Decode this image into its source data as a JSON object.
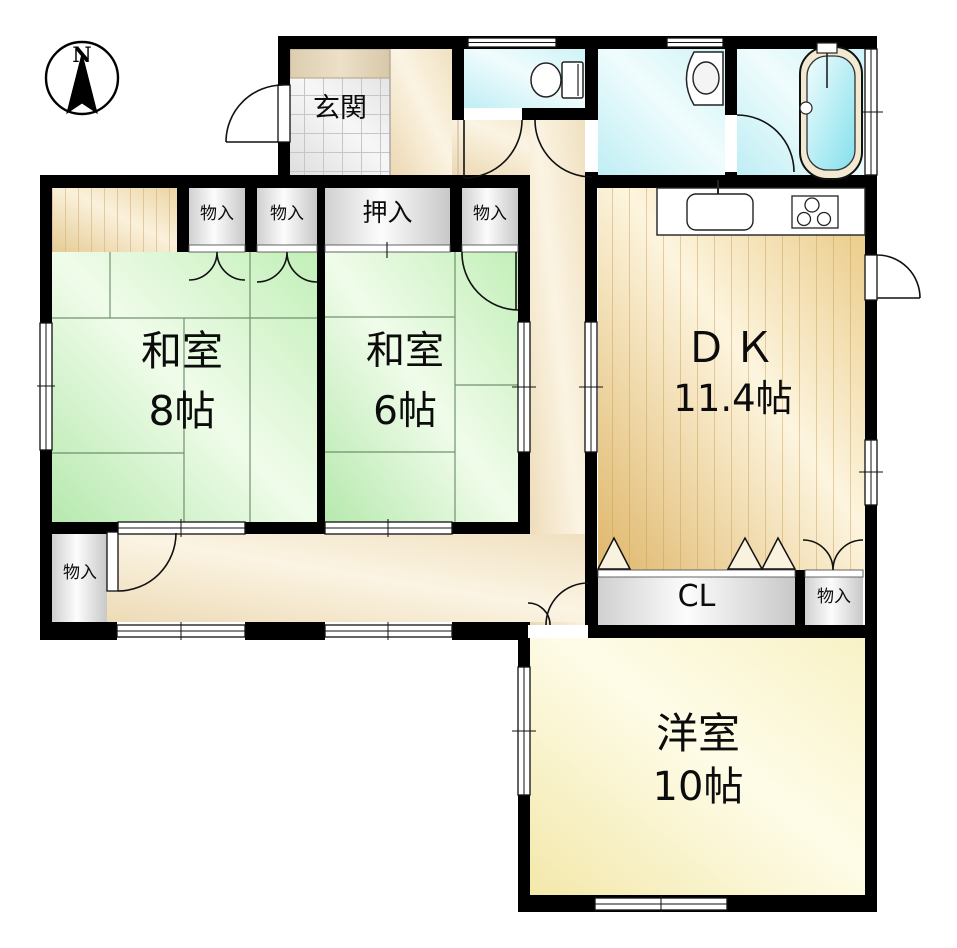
{
  "compass": {
    "label": "N"
  },
  "rooms": {
    "genkan": {
      "label": "玄関"
    },
    "washitsu8": {
      "name": "和室",
      "size": "8帖"
    },
    "washitsu6": {
      "name": "和室",
      "size": "6帖"
    },
    "dk": {
      "name": "ＤＫ",
      "size": "11.4帖"
    },
    "youshitsu": {
      "name": "洋室",
      "size": "10帖"
    }
  },
  "closets": {
    "north1": "物入",
    "north2": "物入",
    "oshiire": "押入",
    "north3": "物入",
    "hall_sw": "物入",
    "cl": "CL",
    "dk_south": "物入"
  },
  "colors": {
    "tatami": "#c9efc0",
    "wood_floor": "#eac983",
    "hallway": "#f3e6c9",
    "western_room": "#f9f2c6",
    "water_rooms": "#cdf1f6",
    "closet": "#e8e8e8",
    "wall": "#000000"
  }
}
